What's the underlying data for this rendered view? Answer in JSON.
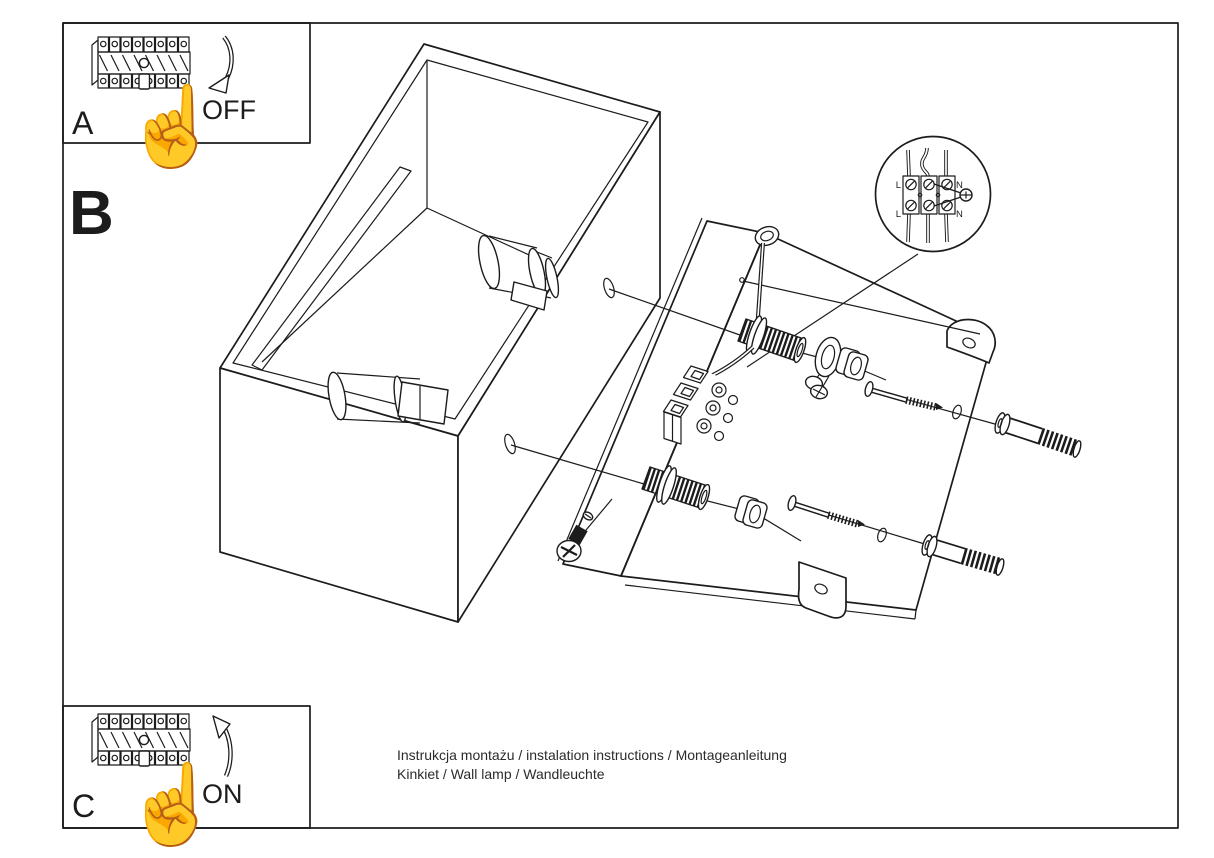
{
  "page": {
    "background": "#ffffff",
    "ink": "#1c1c1c"
  },
  "steps": {
    "a": {
      "label": "A",
      "action": "OFF",
      "hand_icon": "☝"
    },
    "b": {
      "label": "B"
    },
    "c": {
      "label": "C",
      "action": "ON",
      "hand_icon": "☝"
    }
  },
  "wiring_detail": {
    "labels": {
      "line_top": "L",
      "line_bottom": "L",
      "neutral_top": "N",
      "neutral_bottom": "N"
    }
  },
  "footer": {
    "line1": "Instrukcja montażu / instalation instructions / Montageanleitung",
    "line2": "Kinkiet / Wall lamp / Wandleuchte"
  }
}
